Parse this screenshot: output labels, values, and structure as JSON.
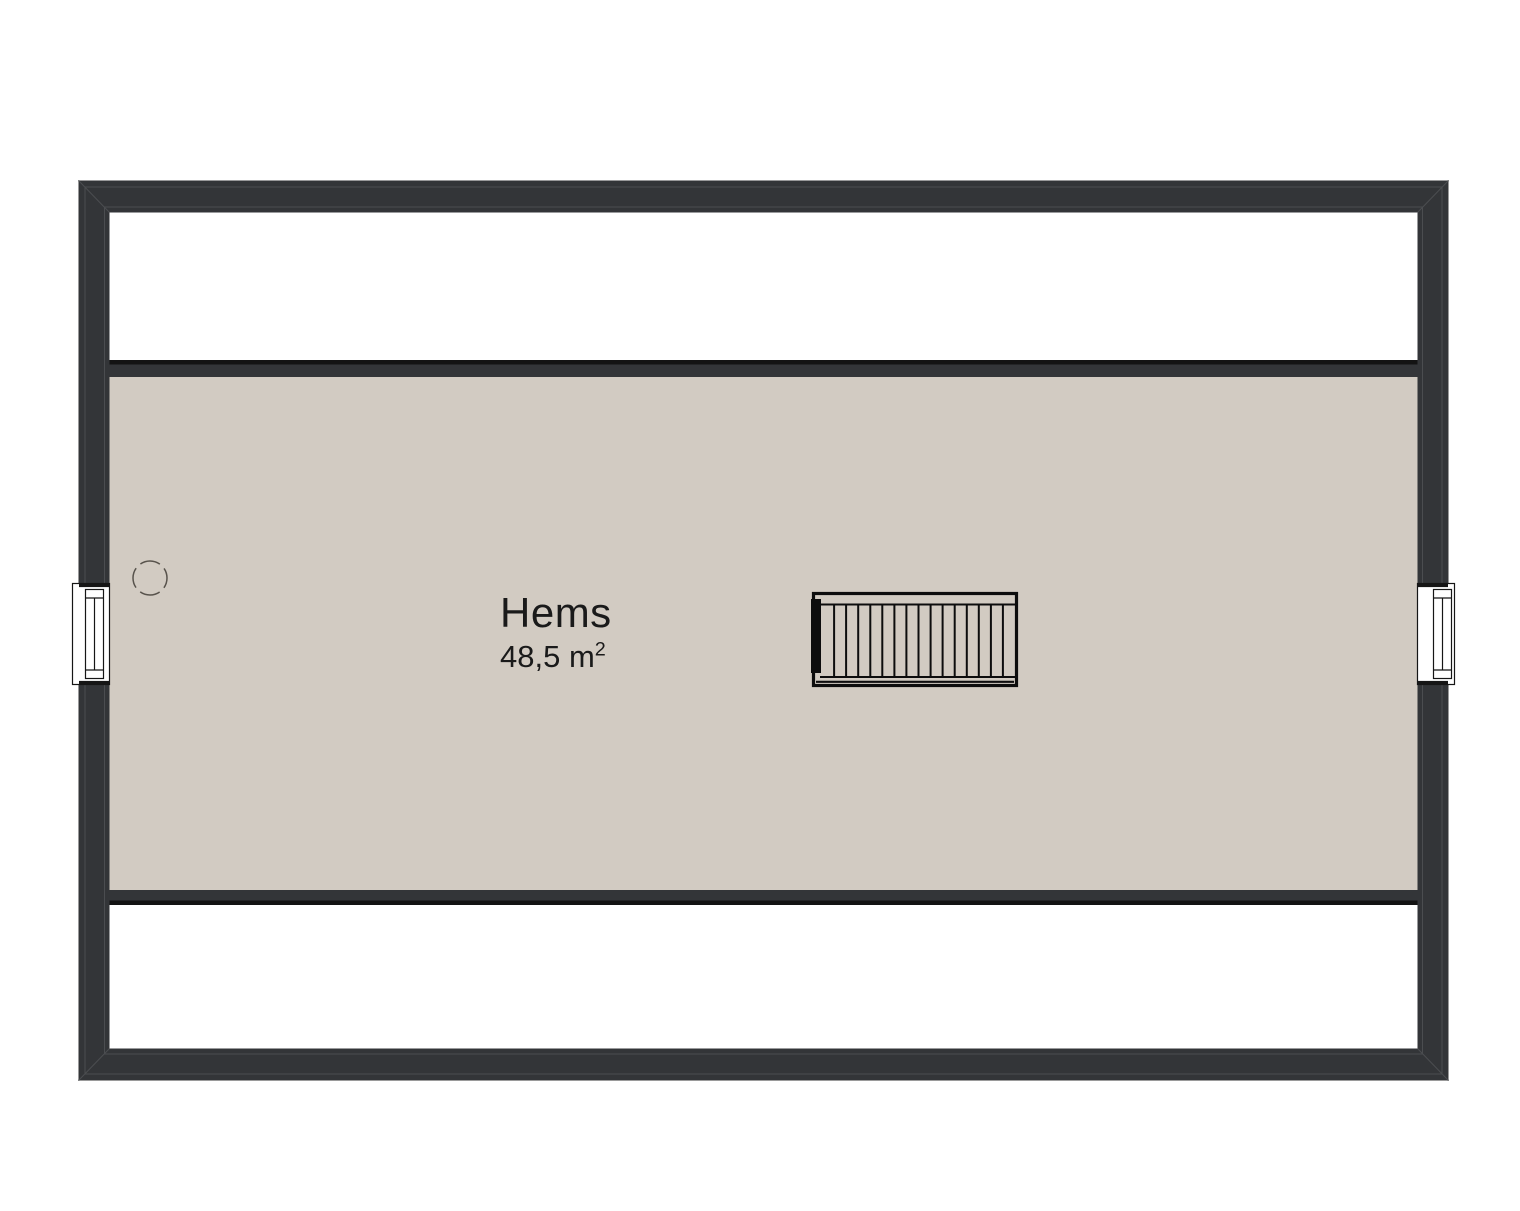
{
  "room": {
    "label": "Hems",
    "area": "48,5 m",
    "area_sup": "2"
  },
  "colors": {
    "background": "#ffffff",
    "wall": "#333538",
    "wall_detail_line": "#4b4d50",
    "wall_outer_hairline": "#9a9a9a",
    "knee_wall_edge_black": "#131313",
    "floor": "#d2cbc2",
    "attic_band": "#ffffff",
    "window_fill": "#ffffff",
    "window_line": "#161616",
    "stair_line": "#0d0d0d",
    "dashed_circle": "#58534c",
    "text": "#1a1a1a"
  }
}
